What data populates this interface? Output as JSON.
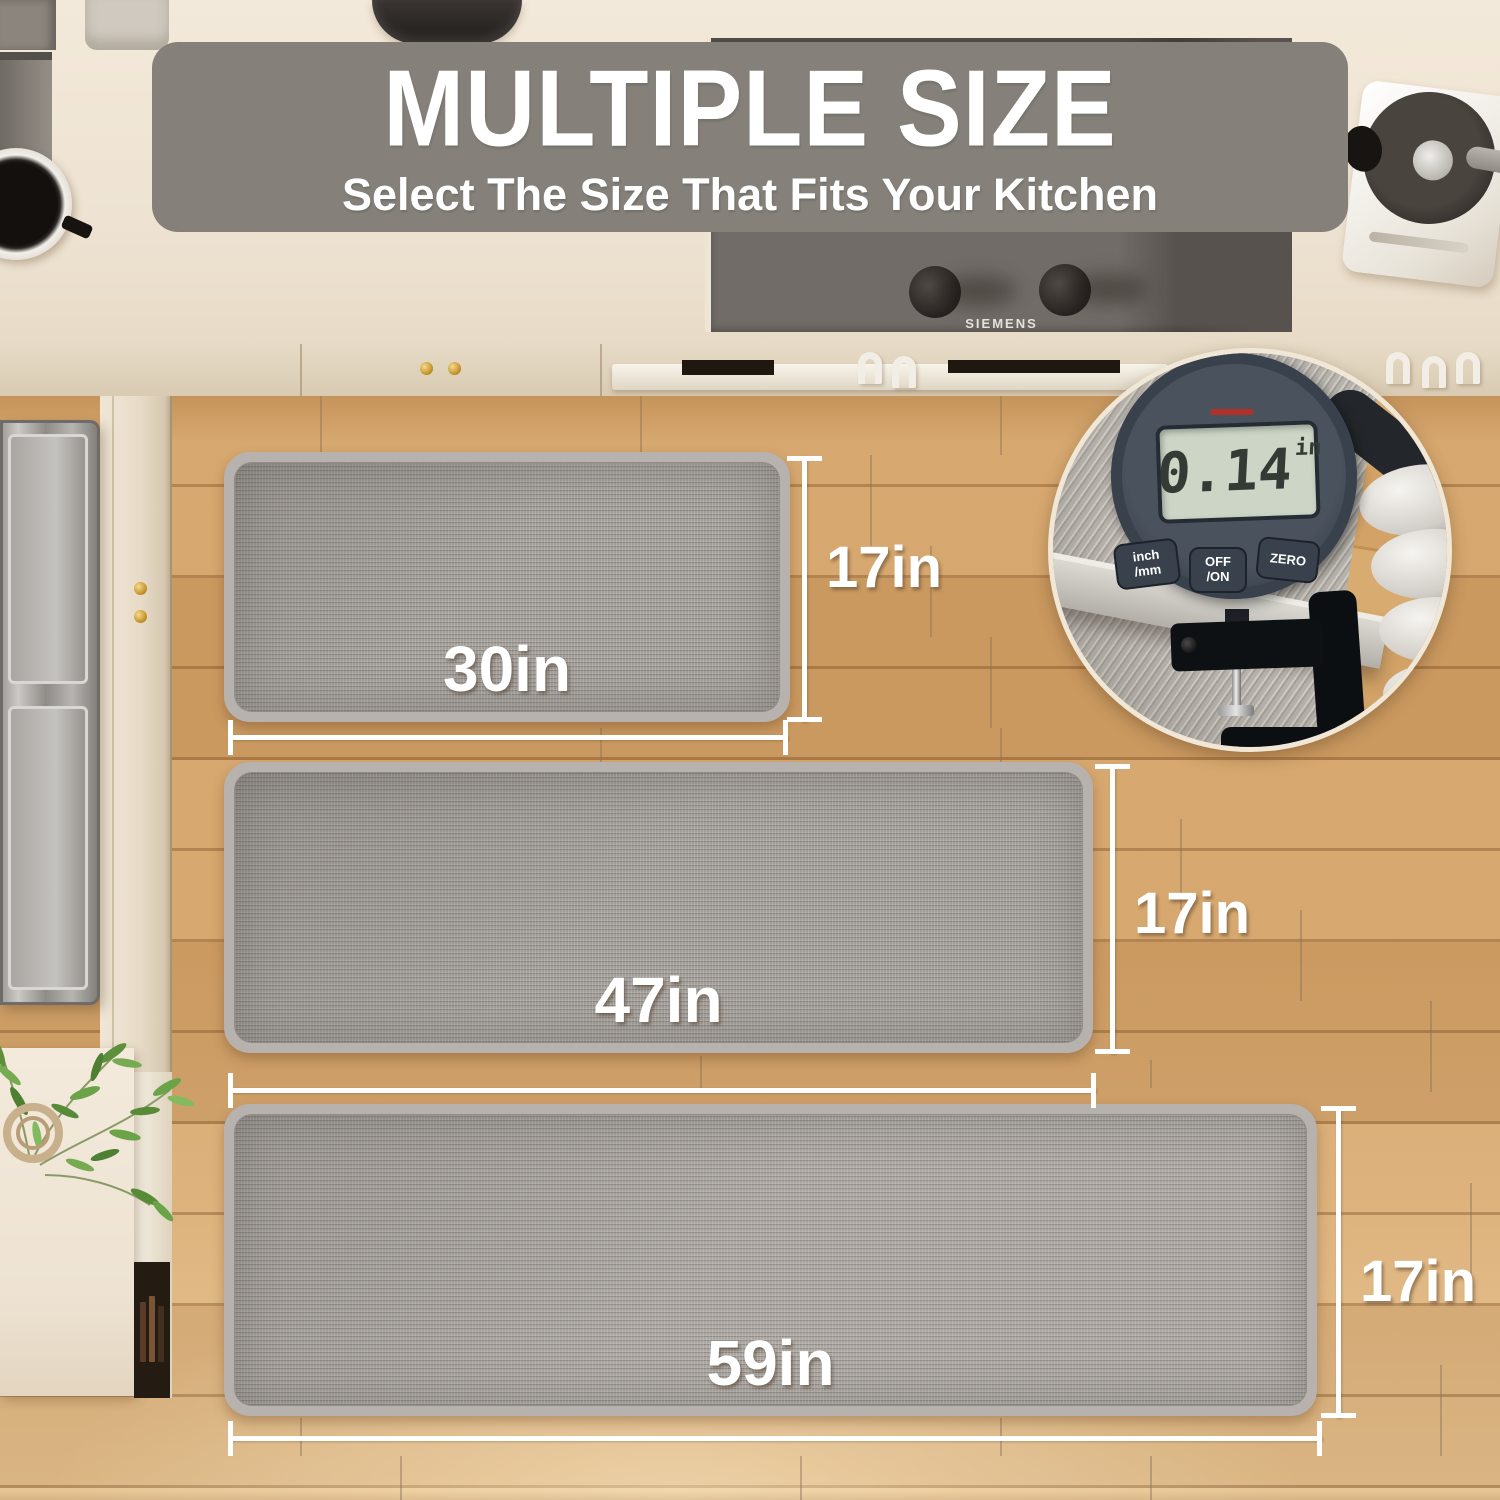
{
  "banner": {
    "title": "MULTIPLE SIZE",
    "subtitle": "Select The Size That Fits Your Kitchen"
  },
  "stove": {
    "brand": "SIEMENS"
  },
  "mats": [
    {
      "width_label": "30in",
      "height_label": "17in"
    },
    {
      "width_label": "47in",
      "height_label": "17in"
    },
    {
      "width_label": "59in",
      "height_label": "17in"
    }
  ],
  "gauge": {
    "reading": "0.14",
    "unit": "in",
    "buttons": [
      {
        "line1": "inch",
        "line2": "/mm"
      },
      {
        "line1": "OFF",
        "line2": "/ON"
      },
      {
        "line1": "ZERO",
        "line2": ""
      }
    ]
  },
  "colors": {
    "banner_gray": "#85817A",
    "mat_surface": "#A29D98",
    "mat_border": "#B7B2AD",
    "wood_floor": "#D2A268",
    "dimension_white": "#FFFFFF",
    "gauge_body": "#39414C",
    "gauge_lcd": "#CCD5C6",
    "counter_cream": "#EEE3D2"
  }
}
